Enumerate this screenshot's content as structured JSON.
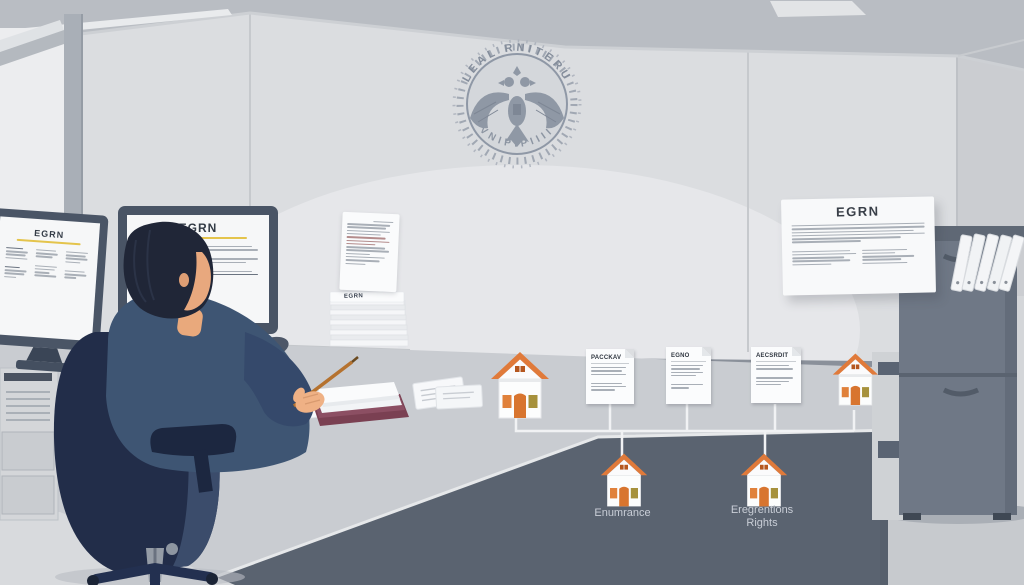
{
  "seal": {
    "top_text": "LEAL RNITERU",
    "bottom_text": "VNIPIPIIII"
  },
  "monitor_left": {
    "title": "EGRN"
  },
  "monitor_main": {
    "title": "EGRN"
  },
  "desk": {
    "stack_label": "EGRN"
  },
  "wall_poster": {
    "title": "EGRN"
  },
  "diagram": {
    "cards": [
      {
        "title": "PACCKAV"
      },
      {
        "title": "EGNO"
      },
      {
        "title": "AECSRDIT"
      }
    ],
    "labels": {
      "house_mid": "Enumrance",
      "house_right_line1": "Eregrentions",
      "house_right_line2": "Rights"
    }
  },
  "icons": {
    "seal": "double-headed-eagle-seal-icon",
    "house": "house-icon",
    "binder": "ring-binder-icon"
  },
  "colors": {
    "accent_orange": "#E07A3A",
    "olive_window": "#A6913C",
    "suit_navy": "#3E5573",
    "chair_navy": "#222D49",
    "wall_gray": "#DBDDE0",
    "desk_front": "#5A6370",
    "seal_gray": "#8F98A5",
    "underline_yellow": "#E4C44C",
    "connector_white": "#F1F2F4"
  }
}
